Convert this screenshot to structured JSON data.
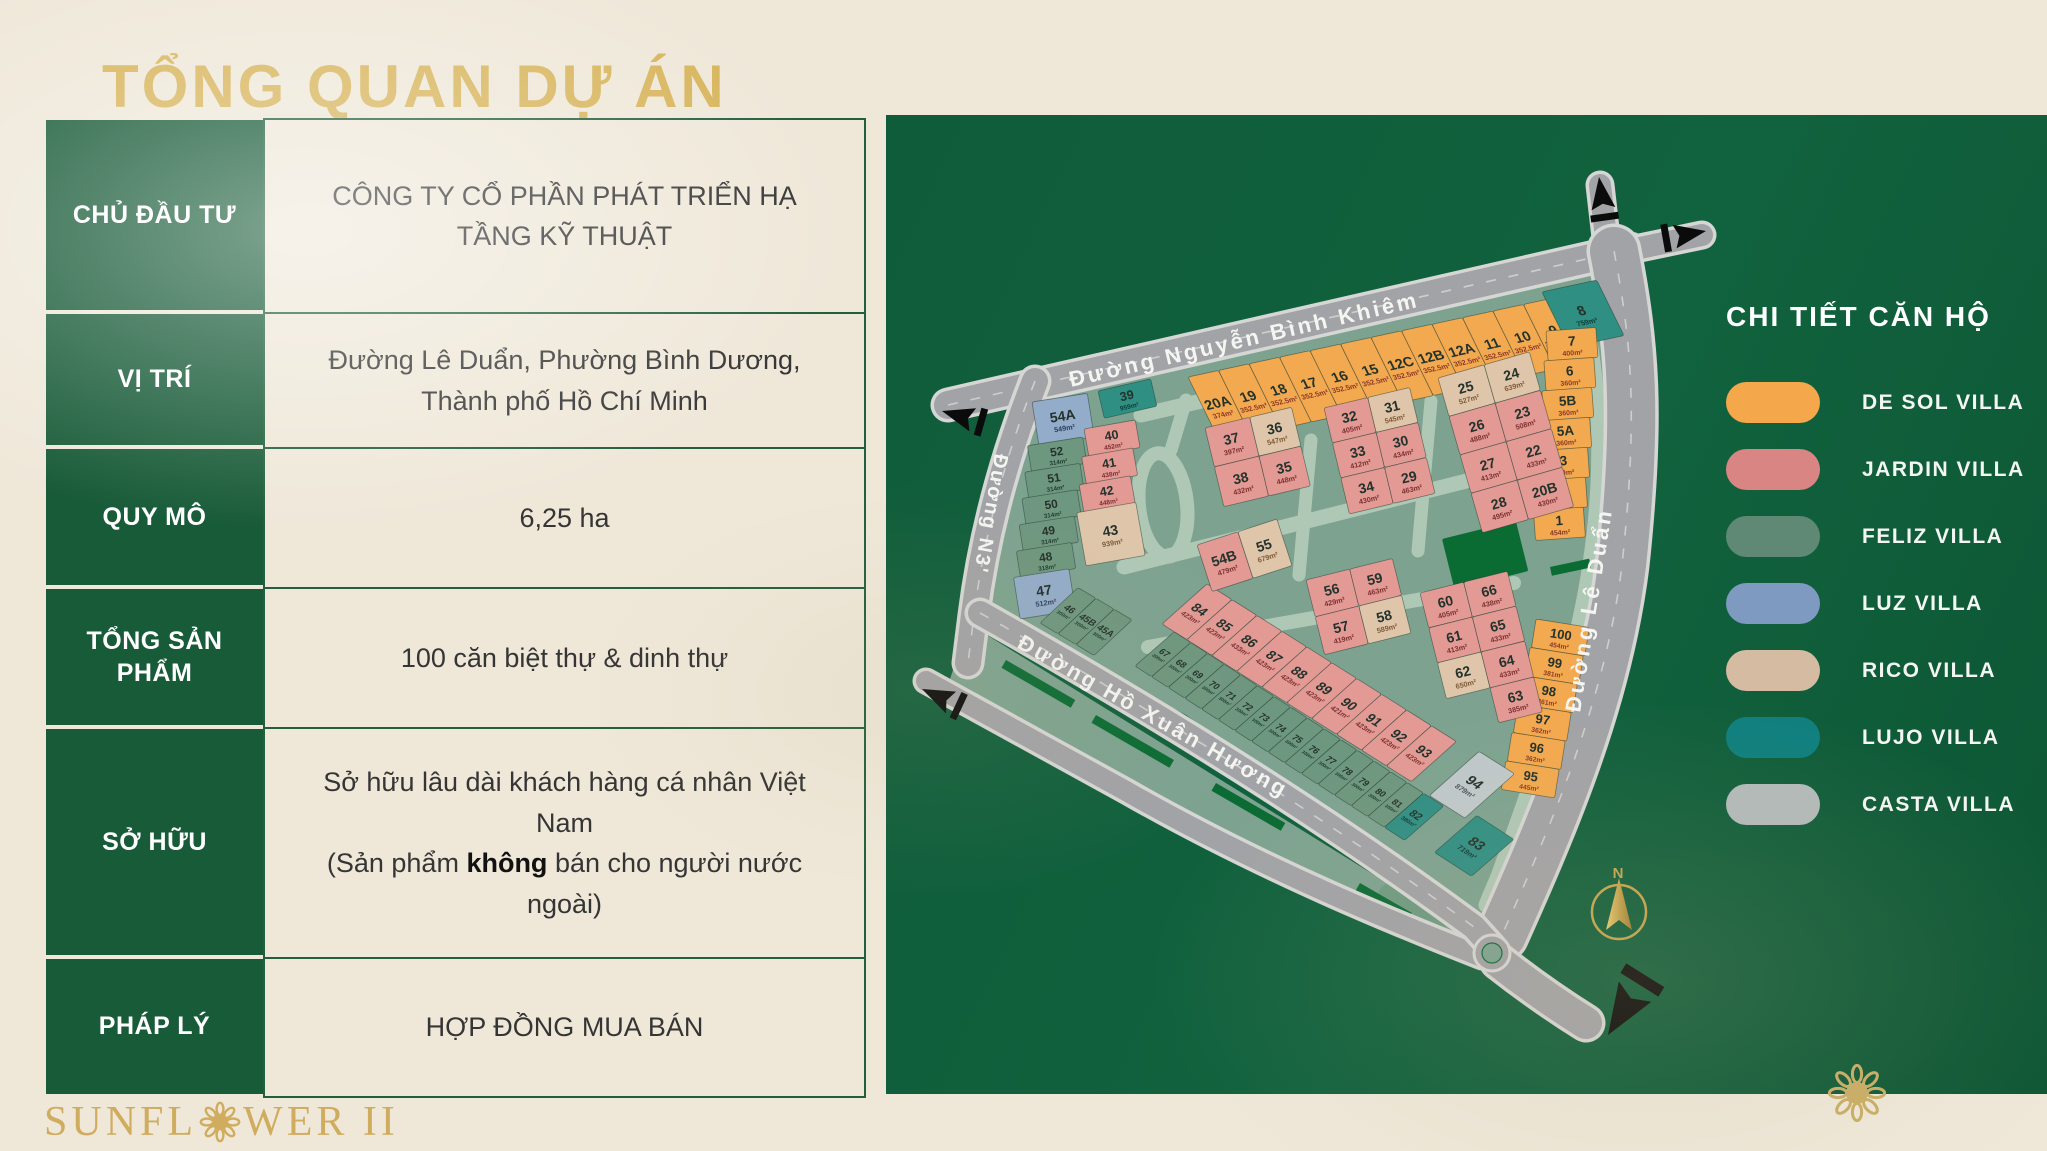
{
  "title": "TỔNG QUAN DỰ ÁN",
  "table": {
    "rows": [
      {
        "label": "CHỦ ĐẦU TƯ",
        "value": "CÔNG TY CỔ PHẦN PHÁT TRIỂN HẠ TẦNG KỸ THUẬT"
      },
      {
        "label": "VỊ TRÍ",
        "value": "Đường Lê Duẩn, Phường Bình Dương, Thành phố Hồ Chí Minh"
      },
      {
        "label": "QUY MÔ",
        "value": "6,25 ha"
      },
      {
        "label": "TỔNG SẢN PHẨM",
        "value": "100 căn biệt thự & dinh thự"
      },
      {
        "label": "SỞ HỮU",
        "line1": "Sở hữu lâu dài khách hàng cá nhân Việt Nam",
        "pre": "(Sản phẩm ",
        "bold": "không",
        "post": " bán cho người nước ngoài)"
      },
      {
        "label": "PHÁP LÝ",
        "value": "HỢP ĐỒNG MUA BÁN"
      }
    ]
  },
  "logo": {
    "text_pre": "SUNFL",
    "text_post": "WER II"
  },
  "legend": {
    "title": "CHI TIẾT CĂN HỘ",
    "villas": [
      {
        "key": "desol",
        "name": "DE SOL VILLA",
        "color": "#F4A84B"
      },
      {
        "key": "jardin",
        "name": "JARDIN VILLA",
        "color": "#D98584"
      },
      {
        "key": "feliz",
        "name": "FELIZ VILLA",
        "color": "#5F8974"
      },
      {
        "key": "luz",
        "name": "LUZ VILLA",
        "color": "#7F9AC1"
      },
      {
        "key": "rico",
        "name": "RICO VILLA",
        "color": "#D5BBA2"
      },
      {
        "key": "lujo",
        "name": "LUJO VILLA",
        "color": "#0F7F7E"
      },
      {
        "key": "casta",
        "name": "CASTA VILLA",
        "color": "#B3BABA"
      }
    ]
  },
  "map": {
    "streets": {
      "nbk": "Đường Nguyễn Bình Khiêm",
      "n3": "Đường N3'",
      "hxh": "Đường Hồ Xuân Hương",
      "leduan": "Đường Lê Duẩn"
    },
    "compass_label": "N",
    "groups": {
      "top_row": [
        {
          "n": "20A",
          "a": "374m²",
          "c": "desol"
        },
        {
          "n": "19",
          "a": "352.5m²",
          "c": "desol"
        },
        {
          "n": "18",
          "a": "352.5m²",
          "c": "desol"
        },
        {
          "n": "17",
          "a": "352.5m²",
          "c": "desol"
        },
        {
          "n": "16",
          "a": "352.5m²",
          "c": "desol"
        },
        {
          "n": "15",
          "a": "352.5m²",
          "c": "desol"
        },
        {
          "n": "12C",
          "a": "352.5m²",
          "c": "desol"
        },
        {
          "n": "12B",
          "a": "352.5m²",
          "c": "desol"
        },
        {
          "n": "12A",
          "a": "352.5m²",
          "c": "desol"
        },
        {
          "n": "11",
          "a": "352.5m²",
          "c": "desol"
        },
        {
          "n": "10",
          "a": "352.5m²",
          "c": "desol"
        },
        {
          "n": "9",
          "a": "352.5m²",
          "c": "desol"
        },
        {
          "n": "8",
          "a": "759m²",
          "c": "lujo",
          "w": 56,
          "h": 60,
          "ox": -12,
          "oy": -6
        }
      ],
      "right_col": [
        {
          "n": "7",
          "a": "400m²",
          "c": "desol"
        },
        {
          "n": "6",
          "a": "360m²",
          "c": "desol"
        },
        {
          "n": "5B",
          "a": "360m²",
          "c": "desol"
        },
        {
          "n": "5A",
          "a": "360m²",
          "c": "desol"
        },
        {
          "n": "3",
          "a": "360m²",
          "c": "desol"
        },
        {
          "n": "2",
          "a": "360m²",
          "c": "desol"
        },
        {
          "n": "1",
          "a": "454m²",
          "c": "desol"
        }
      ],
      "se_col": [
        {
          "n": "100",
          "a": "454m²",
          "c": "desol"
        },
        {
          "n": "99",
          "a": "381m²",
          "c": "desol"
        },
        {
          "n": "98",
          "a": "361m²",
          "c": "desol"
        },
        {
          "n": "97",
          "a": "362m²",
          "c": "desol"
        },
        {
          "n": "96",
          "a": "362m²",
          "c": "desol"
        },
        {
          "n": "95",
          "a": "445m²",
          "c": "desol"
        }
      ],
      "left_col": [
        {
          "n": "54A",
          "a": "549m²",
          "c": "luz",
          "h": 44
        },
        {
          "n": "52",
          "a": "314m²",
          "c": "feliz"
        },
        {
          "n": "51",
          "a": "314m²",
          "c": "feliz"
        },
        {
          "n": "50",
          "a": "314m²",
          "c": "feliz"
        },
        {
          "n": "49",
          "a": "314m²",
          "c": "feliz"
        },
        {
          "n": "48",
          "a": "318m²",
          "c": "feliz"
        },
        {
          "n": "47",
          "a": "512m²",
          "c": "luz",
          "h": 42
        }
      ],
      "mid_col": [
        {
          "n": "40",
          "a": "452m²",
          "c": "jardin"
        },
        {
          "n": "41",
          "a": "438m²",
          "c": "jardin"
        },
        {
          "n": "42",
          "a": "448m²",
          "c": "jardin"
        },
        {
          "n": "43",
          "a": "939m²",
          "c": "rico",
          "w": 60,
          "h": 54
        }
      ],
      "lot_39": [
        {
          "n": "39",
          "a": "959m²",
          "c": "lujo"
        }
      ],
      "row_45": [
        {
          "n": "46",
          "a": "300m²",
          "c": "feliz"
        },
        {
          "n": "45B",
          "a": "300m²",
          "c": "feliz"
        },
        {
          "n": "45A",
          "a": "300m²",
          "c": "feliz"
        }
      ],
      "block_b": [
        {
          "n": "37",
          "a": "397m²",
          "c": "jardin"
        },
        {
          "n": "36",
          "a": "547m²",
          "c": "rico"
        },
        {
          "n": "38",
          "a": "432m²",
          "c": "jardin"
        },
        {
          "n": "35",
          "a": "448m²",
          "c": "jardin"
        }
      ],
      "block_a": [
        {
          "n": "32",
          "a": "405m²",
          "c": "jardin"
        },
        {
          "n": "31",
          "a": "545m²",
          "c": "rico"
        },
        {
          "n": "33",
          "a": "412m²",
          "c": "jardin"
        },
        {
          "n": "30",
          "a": "434m²",
          "c": "jardin"
        },
        {
          "n": "34",
          "a": "430m²",
          "c": "jardin"
        },
        {
          "n": "29",
          "a": "463m²",
          "c": "jardin"
        }
      ],
      "block_c": [
        {
          "n": "25",
          "a": "527m²",
          "c": "rico"
        },
        {
          "n": "24",
          "a": "639m²",
          "c": "rico"
        },
        {
          "n": "26",
          "a": "488m²",
          "c": "jardin"
        },
        {
          "n": "23",
          "a": "508m²",
          "c": "jardin"
        },
        {
          "n": "27",
          "a": "413m²",
          "c": "jardin"
        },
        {
          "n": "22",
          "a": "433m²",
          "c": "jardin"
        },
        {
          "n": "28",
          "a": "495m²",
          "c": "jardin"
        },
        {
          "n": "20B",
          "a": "430m²",
          "c": "jardin"
        }
      ],
      "block_f": [
        {
          "n": "54B",
          "a": "479m²",
          "c": "jardin"
        },
        {
          "n": "55",
          "a": "679m²",
          "c": "rico"
        }
      ],
      "block_d": [
        {
          "n": "56",
          "a": "429m²",
          "c": "jardin"
        },
        {
          "n": "59",
          "a": "463m²",
          "c": "jardin"
        },
        {
          "n": "57",
          "a": "419m²",
          "c": "jardin"
        },
        {
          "n": "58",
          "a": "589m²",
          "c": "rico"
        }
      ],
      "block_e": [
        {
          "n": "60",
          "a": "405m²",
          "c": "jardin"
        },
        {
          "n": "66",
          "a": "438m²",
          "c": "jardin"
        },
        {
          "n": "61",
          "a": "413m²",
          "c": "jardin"
        },
        {
          "n": "65",
          "a": "433m²",
          "c": "jardin"
        },
        {
          "n": "62",
          "a": "650m²",
          "c": "rico"
        },
        {
          "n": "64",
          "a": "433m²",
          "c": "jardin"
        },
        null,
        {
          "n": "63",
          "a": "385m²",
          "c": "jardin"
        }
      ],
      "row_84": [
        {
          "n": "84",
          "a": "423m²",
          "c": "jardin"
        },
        {
          "n": "85",
          "a": "423m²",
          "c": "jardin"
        },
        {
          "n": "86",
          "a": "433m²",
          "c": "jardin"
        },
        {
          "n": "87",
          "a": "423m²",
          "c": "jardin"
        },
        {
          "n": "88",
          "a": "423m²",
          "c": "jardin"
        },
        {
          "n": "89",
          "a": "423m²",
          "c": "jardin"
        },
        {
          "n": "90",
          "a": "421m²",
          "c": "jardin"
        },
        {
          "n": "91",
          "a": "423m²",
          "c": "jardin"
        },
        {
          "n": "92",
          "a": "423m²",
          "c": "jardin"
        },
        {
          "n": "93",
          "a": "423m²",
          "c": "jardin"
        },
        {
          "n": "94",
          "a": "879m²",
          "c": "casta",
          "w": 42,
          "h": 64,
          "ox": 18,
          "oy": 14
        }
      ],
      "row_67": [
        {
          "n": "67",
          "a": "300m²",
          "c": "feliz"
        },
        {
          "n": "68",
          "a": "300m²",
          "c": "feliz"
        },
        {
          "n": "69",
          "a": "300m²",
          "c": "feliz"
        },
        {
          "n": "70",
          "a": "300m²",
          "c": "feliz"
        },
        {
          "n": "71",
          "a": "300m²",
          "c": "feliz"
        },
        {
          "n": "72",
          "a": "300m²",
          "c": "feliz"
        },
        {
          "n": "73",
          "a": "300m²",
          "c": "feliz"
        },
        {
          "n": "74",
          "a": "300m²",
          "c": "feliz"
        },
        {
          "n": "75",
          "a": "300m²",
          "c": "feliz"
        },
        {
          "n": "76",
          "a": "300m²",
          "c": "feliz"
        },
        {
          "n": "77",
          "a": "300m²",
          "c": "feliz"
        },
        {
          "n": "78",
          "a": "300m²",
          "c": "feliz"
        },
        {
          "n": "79",
          "a": "300m²",
          "c": "feliz"
        },
        {
          "n": "80",
          "a": "300m²",
          "c": "feliz"
        },
        {
          "n": "81",
          "a": "300m²",
          "c": "feliz"
        },
        {
          "n": "82",
          "a": "380m²",
          "c": "lujo",
          "w": 24
        },
        {
          "n": "83",
          "a": "719m²",
          "c": "lujo",
          "w": 44,
          "h": 54,
          "ox": 30,
          "oy": 12
        }
      ]
    }
  }
}
